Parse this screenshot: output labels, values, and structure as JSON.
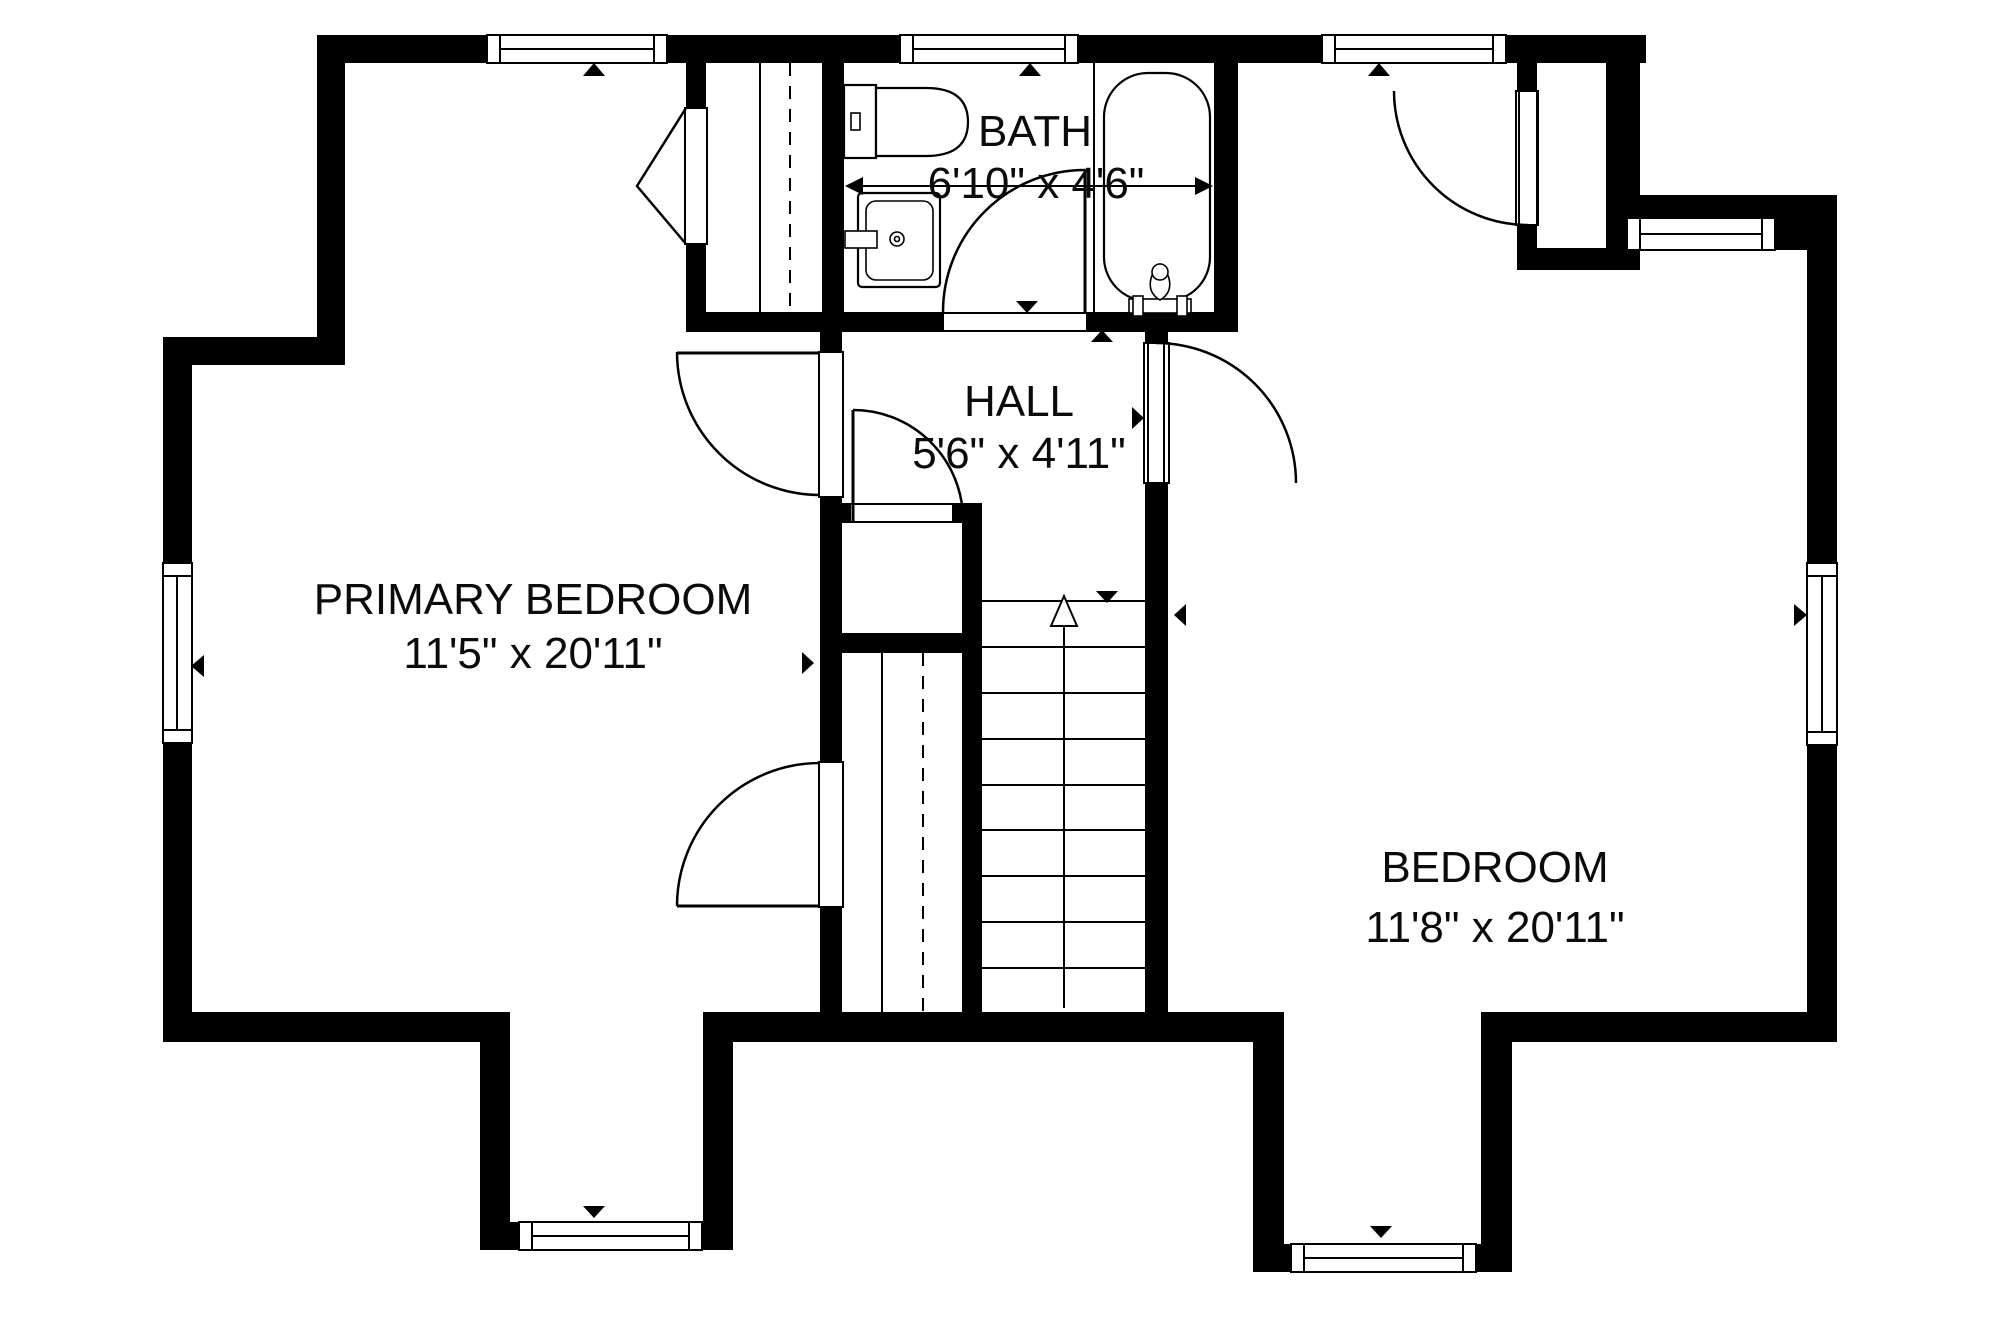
{
  "page": {
    "background_color": "#ffffff",
    "line_color": "#000000",
    "title": "Floor plan"
  },
  "plan": {
    "type": "floor_plan",
    "rooms": [
      {
        "name": "PRIMARY BEDROOM",
        "dims": "11'5\" x 20'11\""
      },
      {
        "name": "BATH",
        "dims": "6'10\" x 4'6\""
      },
      {
        "name": "HALL",
        "dims": "5'6\" x 4'11\""
      },
      {
        "name": "BEDROOM",
        "dims": "11'8\" x 20'11\""
      }
    ],
    "features": {
      "windows": 8,
      "doors": 7,
      "closets": 4,
      "stairs": {
        "direction": "up",
        "treads": 10
      },
      "bath_fixtures": [
        "toilet",
        "sink",
        "bathtub"
      ]
    }
  }
}
